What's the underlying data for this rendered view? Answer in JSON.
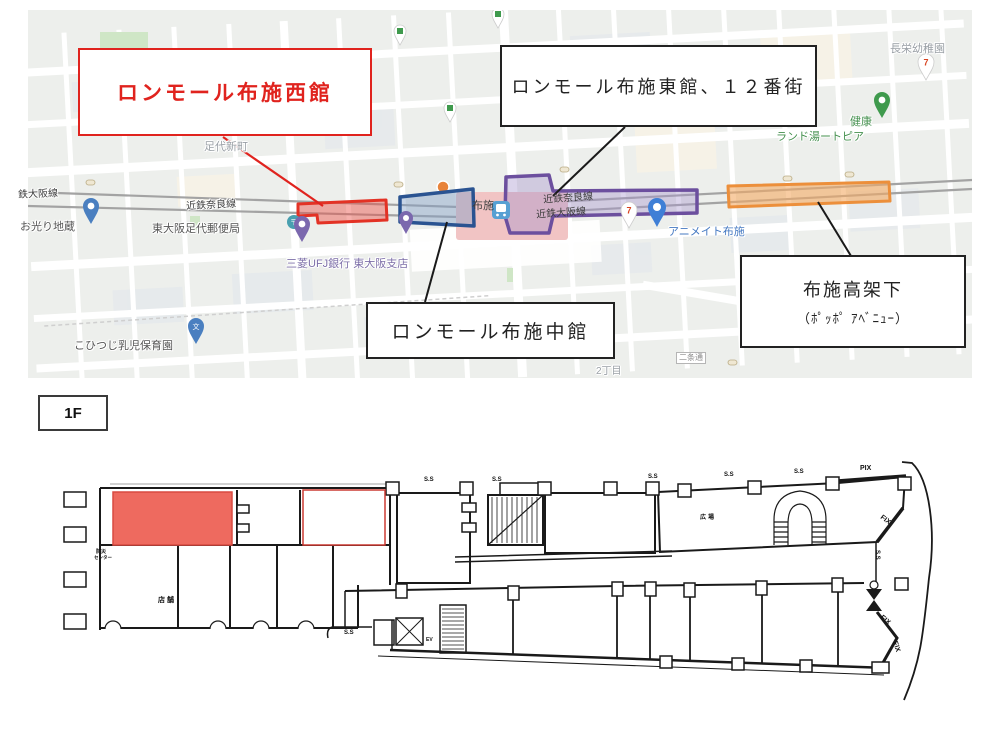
{
  "map": {
    "callouts": {
      "west": "ロンモール布施西館",
      "east": "ロンモール布施東館、１２番街",
      "middle": "ロンモール布施中館",
      "underpass_line1": "布施高架下",
      "underpass_line2": "（ﾎﾟｯﾎﾟ ｱﾍﾞﾆｭｰ）"
    },
    "place_labels": {
      "ashiro_shinmachi": "足代新町",
      "osaka_line_left": "鉄大阪線",
      "nara_line": "近鉄奈良線",
      "nara_line_station": "近鉄奈良線",
      "osaka_line_station": "近鉄大阪線",
      "ohikari_jizo": "お光り地蔵",
      "post_office": "東大阪足代郵便局",
      "bank": "三菱UFJ銀行 東大阪支店",
      "nursery": "こひつじ乳児保育園",
      "chome2": "2丁目",
      "nijo_dori": "二条通",
      "animate_fuse": "アニメイト布施",
      "choei_kindergarten": "長栄幼稚園",
      "kenko": "健康",
      "land_yu": "ランド湯ートピア",
      "station_fuse": "布施",
      "seven_badge": "7"
    },
    "colors": {
      "west_highlight": "#e0231e",
      "middle_highlight": "#2a5391",
      "east_highlight": "#6c4f9e",
      "underpass_highlight": "#ec8f3b"
    }
  },
  "floor": {
    "tag": "1F",
    "highlight_color": "#ee6a5f",
    "notes": {
      "ss": "S.S",
      "pix": "PIX",
      "fix": "FIX",
      "ev": "EV",
      "center_line1": "防災",
      "center_line2": "センター",
      "tenpo": "店舗",
      "hiroba": "広場"
    }
  }
}
